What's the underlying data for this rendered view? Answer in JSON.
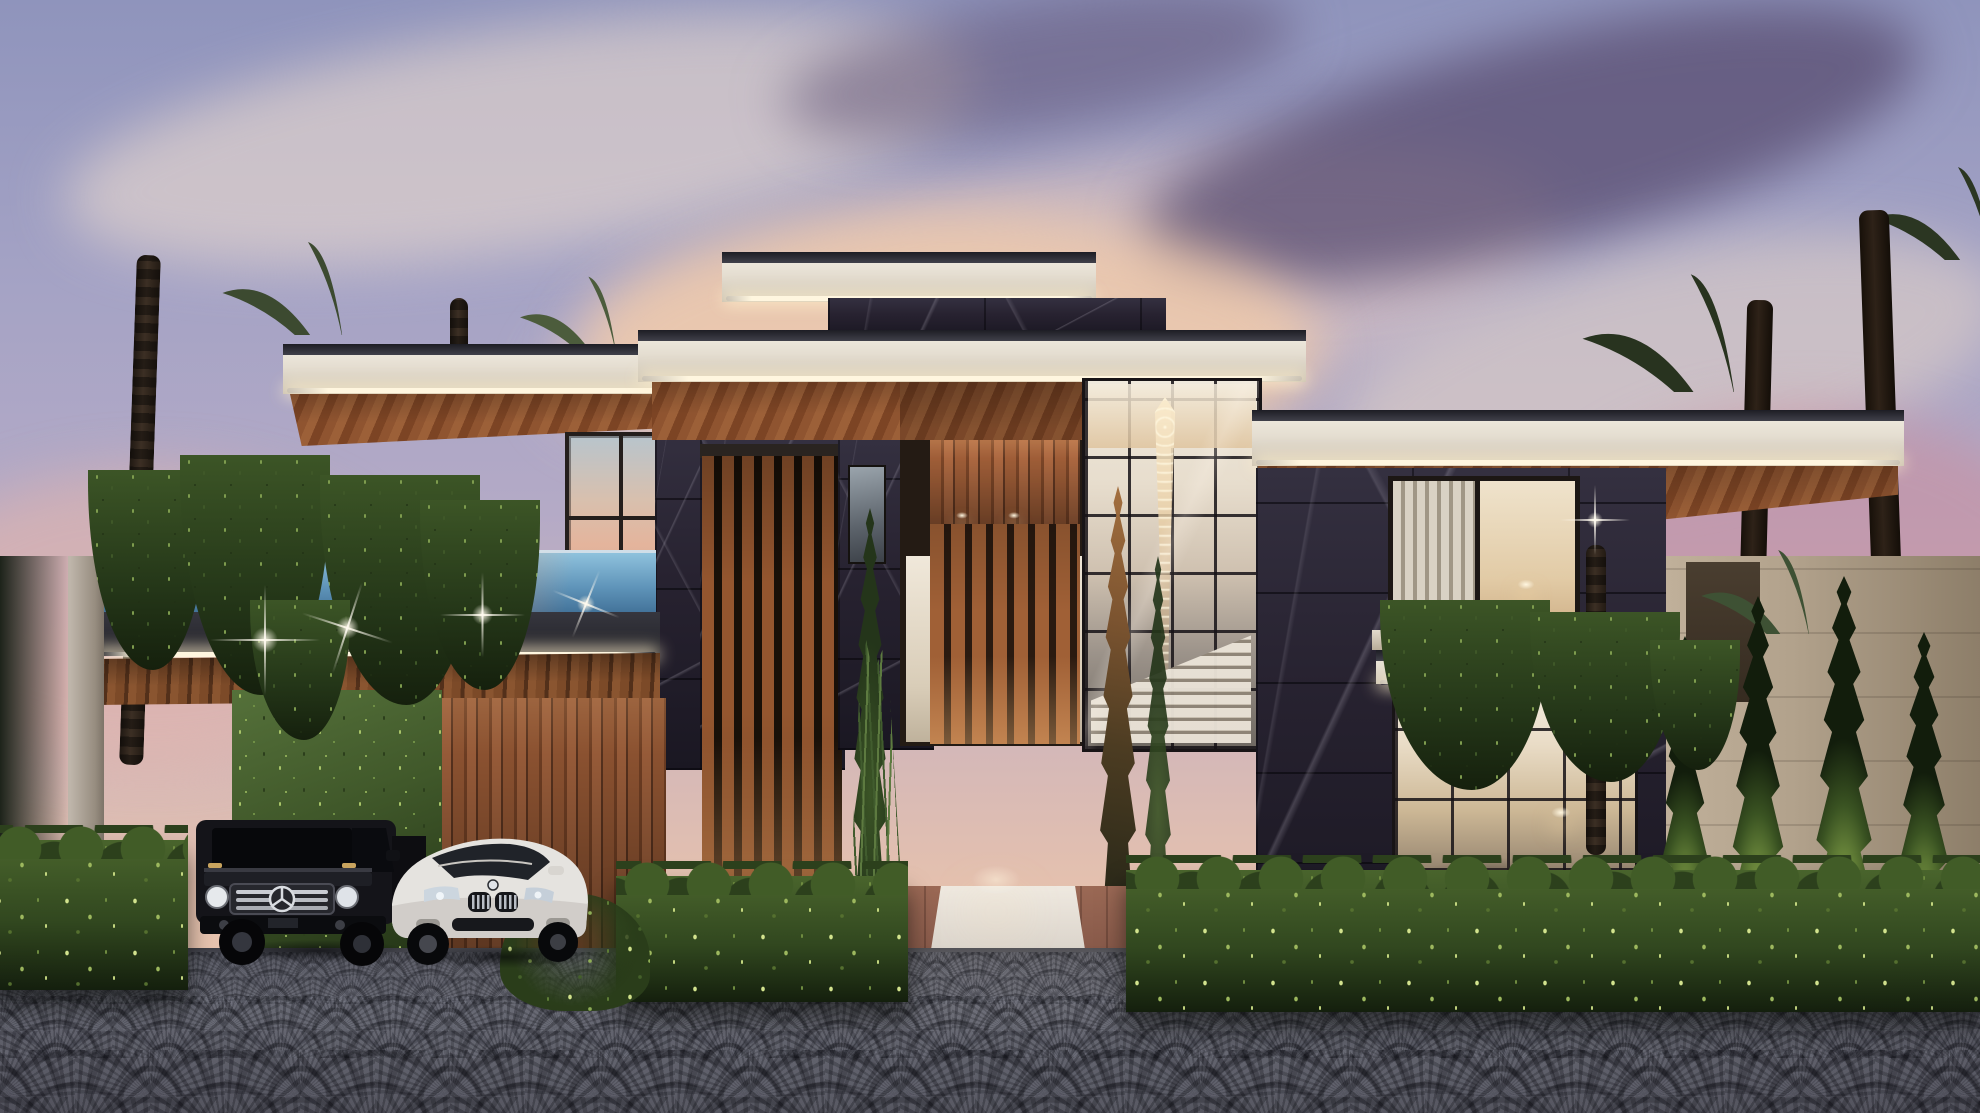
{
  "scene": {
    "type": "architectural-exterior-rendering",
    "subject": "modern luxury villa street elevation",
    "time_of_day": "dusk"
  },
  "labels": {
    "stage": "Photorealistic rendering of a modern luxury villa at dusk",
    "sky": "Lavender dusk sky with pink and dark purple clouds",
    "villa": "Two-story villa with black marble cladding, teak slats, cream cantilevered roof slabs and LED cove lighting",
    "pool_balcony": "Glass-edge pool balcony on the left wing",
    "carport": "Wood-clad carport with star downlights and ivy green wall",
    "entrance": "Central wood-slat entrance with white marble walkway",
    "chandelier": "Double-height crystal chandelier behind glass curtain wall",
    "staircase": "Floating staircase visible through glazing",
    "driveway": "Dark fan-pattern cobblestone driveway",
    "black_suv": "Black Mercedes-Benz G-Class parked in carport",
    "white_suv": "White BMW X6 parked in carport",
    "hedges": "Manicured boxwood hedgerow",
    "palms": "Palm trees and Italian cypresses"
  },
  "objects": {
    "vehicles": [
      {
        "name": "Mercedes-Benz G-Class",
        "color": "black"
      },
      {
        "name": "BMW X6",
        "color": "white"
      }
    ],
    "vegetation": [
      "date palms",
      "fan palms",
      "italian cypress",
      "boxwood hedges",
      "ivy green wall",
      "hanging vines",
      "silver palm shrubs",
      "reed grass"
    ],
    "architecture": [
      "flat cantilevered roofs with LED cove lighting",
      "black marble cladding",
      "teak wood slat screens",
      "double-height glass curtain wall",
      "crystal chandelier",
      "floating staircase",
      "glass-edge pool balcony",
      "wood-clad carport",
      "white marble entrance walkway",
      "fan-pattern cobblestone driveway",
      "stone perimeter wall"
    ]
  },
  "colors": {
    "sky-top": "#8f94bc",
    "sky-mid": "#b4aac6",
    "horizon": "#e5c1ae",
    "cloud-cream": "#f3e0cf",
    "cloud-dark": "#584c70",
    "glow": "#f6cda7",
    "slab": "#f2ede3",
    "cap": "#1d1d24",
    "led": "#fff6df",
    "wood": "#8a5130",
    "wood-deep": "#54301d",
    "soffit": "#9c6038",
    "marble": "#272230",
    "glass-warm": "#efe9dc",
    "pool-hi": "#8fc2dd",
    "pool-lo": "#3e6d94",
    "hedge": "#31471f",
    "hedge-hi": "#d3e38e",
    "ivy": "#40582a",
    "cypress": "#24351a",
    "cypress-lit": "#95b552",
    "stone": "#b2a28c",
    "drive": "#60616b",
    "trunk": "#3c2f24",
    "car-white": "#e5e3df",
    "chrome": "#ccd0d6",
    "walk": "#efe9e0",
    "brick": "#9b6955"
  }
}
